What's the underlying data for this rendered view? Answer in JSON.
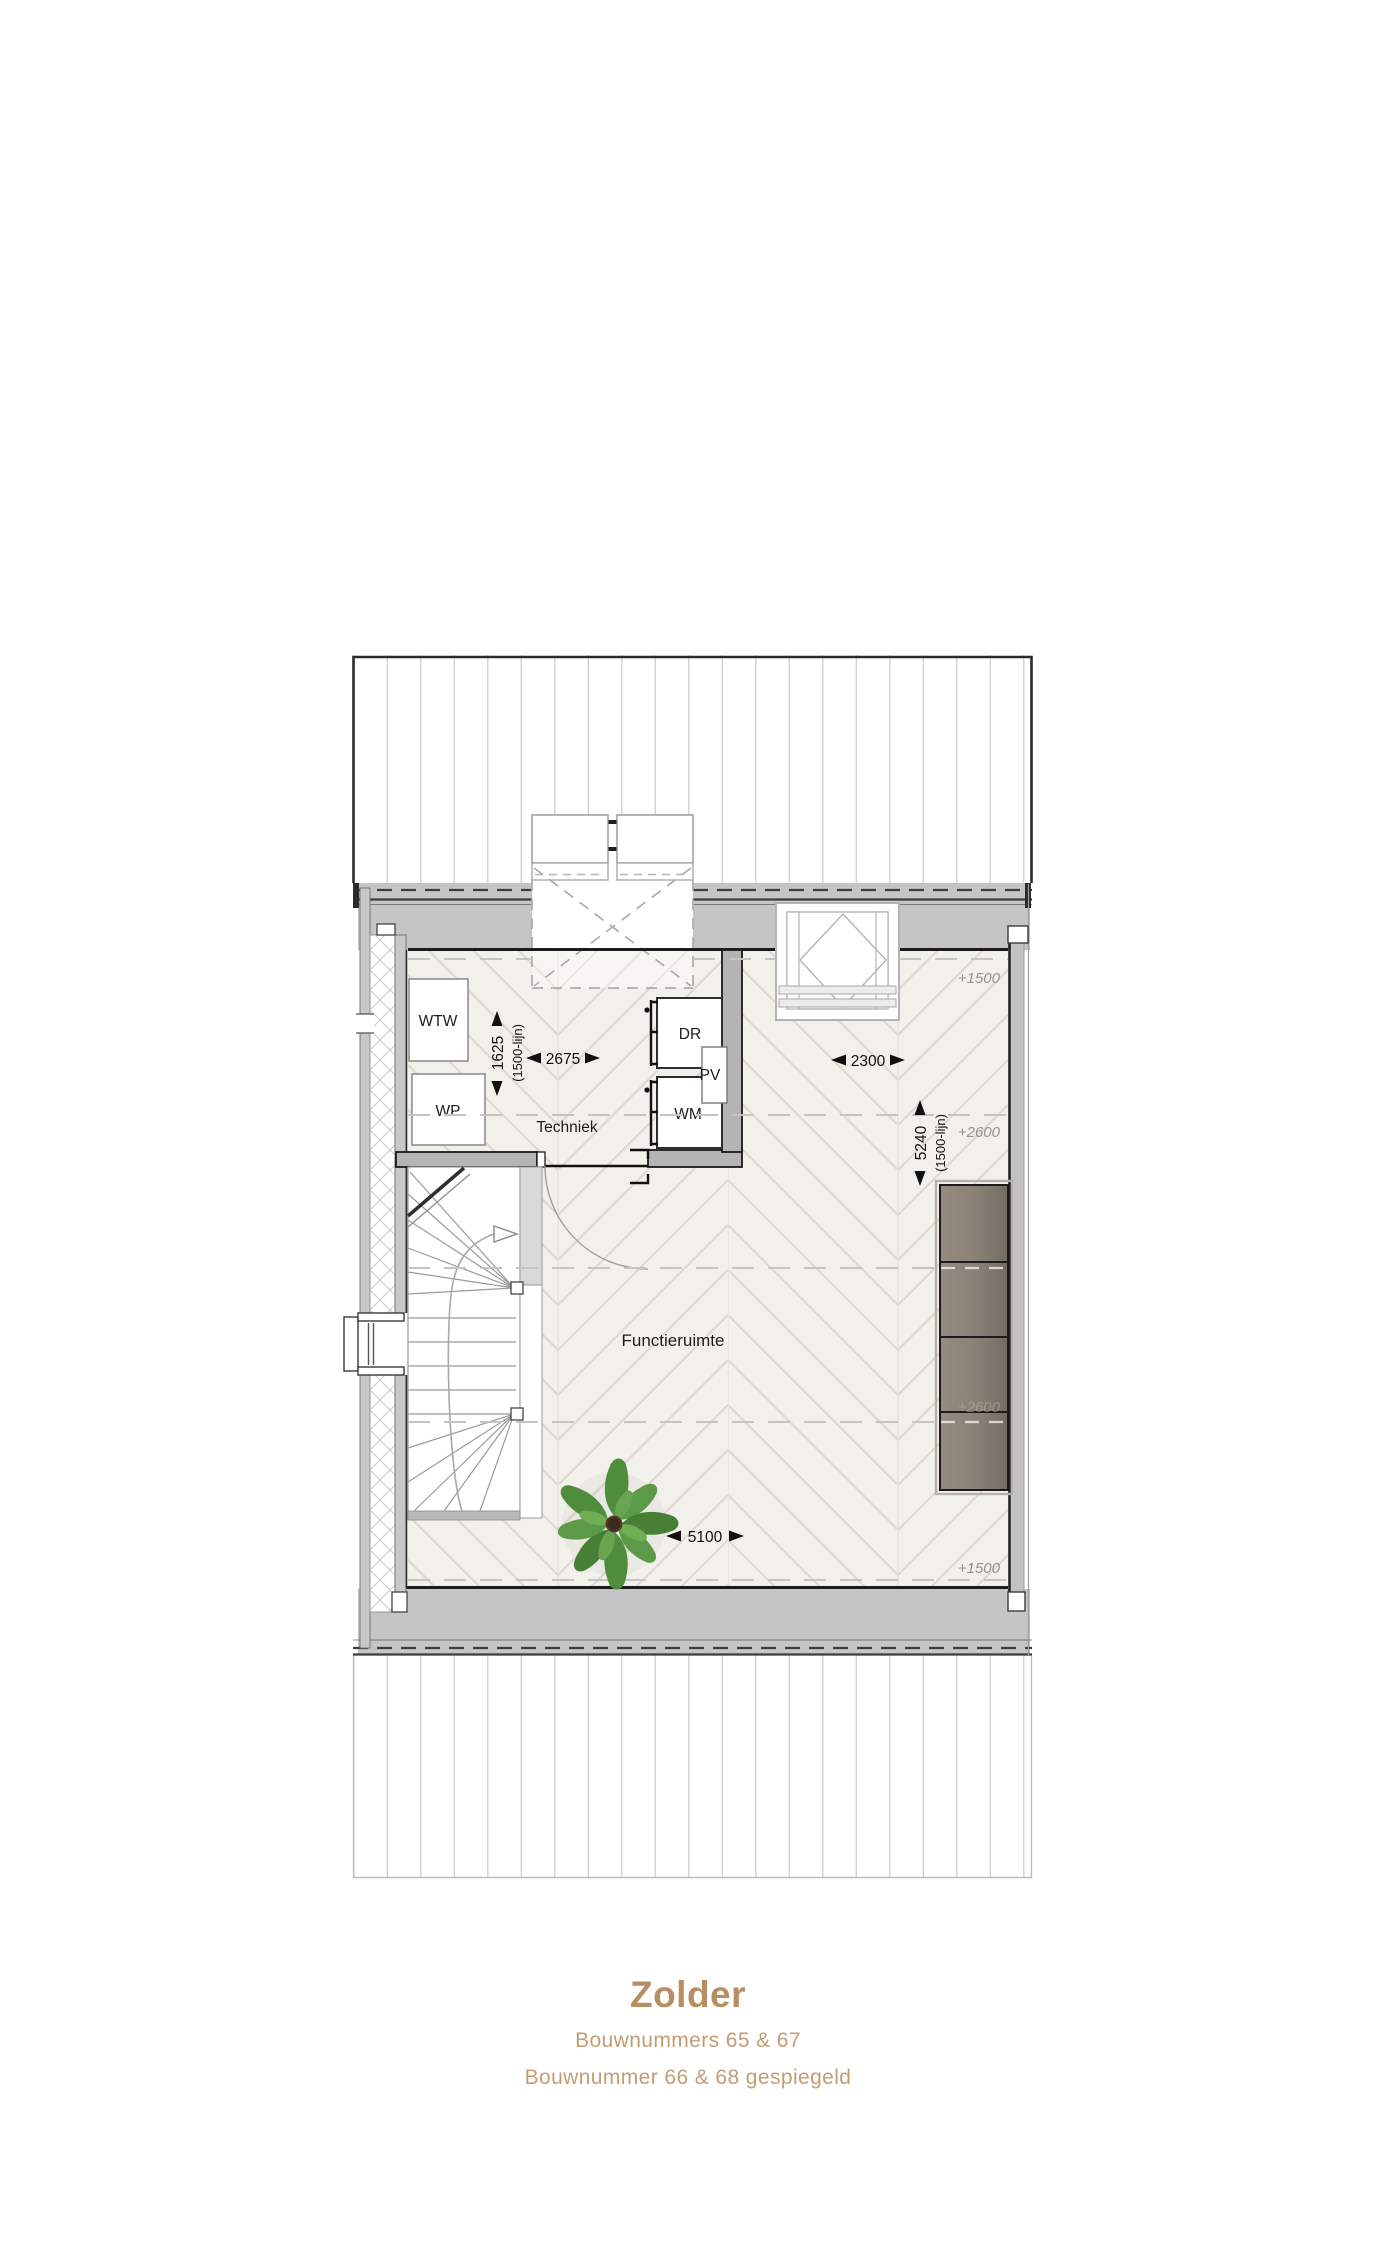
{
  "plan": {
    "rooms": [
      {
        "label": "Techniek"
      },
      {
        "label": "Functieruimte"
      }
    ],
    "equipment": [
      {
        "label": "WTW"
      },
      {
        "label": "WP"
      },
      {
        "label": "DR"
      },
      {
        "label": "PV"
      },
      {
        "label": "WM"
      }
    ],
    "dimensions": [
      {
        "value": "2675"
      },
      {
        "value": "1625",
        "note": "(1500-lijn)"
      },
      {
        "value": "2300"
      },
      {
        "value": "5240",
        "note": "(1500-lijn)"
      },
      {
        "value": "5100"
      }
    ],
    "levels": [
      {
        "label": "+1500"
      },
      {
        "label": "+2600"
      },
      {
        "label": "+2600"
      },
      {
        "label": "+1500"
      }
    ]
  },
  "title_block": {
    "title": "Zolder",
    "line1": "Bouwnummers 65 & 67",
    "line2": "Bouwnummer 66 & 68 gespiegeld"
  },
  "colors": {
    "title_accent": "#b78d62",
    "subtitle_accent": "#c39c74",
    "wall_gray": "#c5c5c5",
    "floor_cream": "#f2f0eb",
    "cabinet_taupe": "#8a8076",
    "plant_green": "#4f8c3c"
  }
}
